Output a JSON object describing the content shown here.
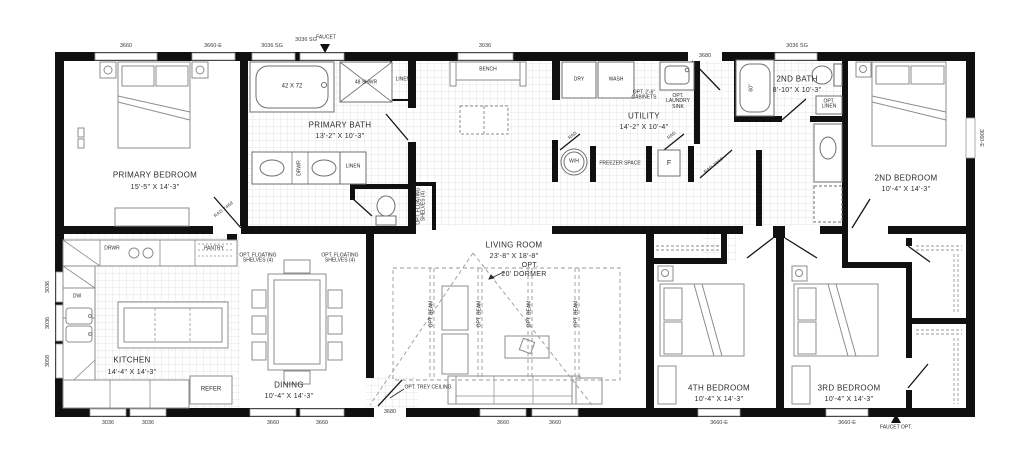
{
  "colors": {
    "wall": "#101010",
    "tile_line": "#dcdcdc",
    "furniture": "#8c8c8c",
    "text": "#2b2b2b"
  },
  "rooms": {
    "primary_bedroom": {
      "name": "PRIMARY BEDROOM",
      "dims": "15'-5\" X 14'-3\""
    },
    "primary_bath": {
      "name": "PRIMARY BATH",
      "dims": "13'-2\" X 10'-3\""
    },
    "utility": {
      "name": "UTILITY",
      "dims": "14'-2\" X 10'-4\""
    },
    "second_bath": {
      "name": "2ND BATH",
      "dims": "8'-10\" X 10'-3\""
    },
    "second_bedroom": {
      "name": "2ND BEDROOM",
      "dims": "10'-4\" X 14'-3\""
    },
    "kitchen": {
      "name": "KITCHEN",
      "dims": "14'-4\" X 14'-3\""
    },
    "dining": {
      "name": "DINING",
      "dims": "10'-4\" X 14'-3\""
    },
    "living_room": {
      "name": "LIVING ROOM",
      "dims": "23'-8\" X 18'-8\"",
      "opt": "OPT.",
      "dormer": "20' DORMER"
    },
    "fourth_bedroom": {
      "name": "4TH BEDROOM",
      "dims": "10'-4\" X 14'-3\""
    },
    "third_bedroom": {
      "name": "3RD BEDROOM",
      "dims": "10'-4\" X 14'-3\""
    }
  },
  "labels": {
    "tub": "42 X 72",
    "shower": "48 SHWR",
    "linen_upper": "LINEN",
    "linen_vanity": "LINEN",
    "drwr_vanity": "DRWR",
    "faucet_top": "FAUCET",
    "bench": "BENCH",
    "dry": "DRY",
    "wash": "WASH",
    "opt_cabinets": "OPT. 2'-6\" CABINETS",
    "opt_laundry_sink": "OPT. LAUNDRY SINK",
    "water_heater": "W/H",
    "freezer": "FREEZER SPACE",
    "f_box": "F",
    "rad_left": "RAD",
    "rad_right": "RAD",
    "door_primary": "RAD 2468",
    "door_hall": "RAD 2868",
    "tub60": "60\"",
    "opt_linen": "OPT. LINEN",
    "drwr_kitchen": "DRWR",
    "pantry": "PANTRY",
    "dw": "DW",
    "refer": "REFER",
    "shelves_a": "OPT. FLOATING SHELVES (4)",
    "shelves_b": "OPT. FLOATING SHELVES (4)",
    "shelves_c": "OPT. FLOATING SHELVES (4)",
    "trey": "OPT. TREY CEILING",
    "beam": "OPT. BEAM",
    "faucet_opt": "FAUCET OPT."
  },
  "sizes": {
    "top_3660": "3660",
    "top_3660e": "3660-E",
    "top_3036sg_1": "3036 SG",
    "top_3036sg_2": "3036 SG",
    "top_3036": "3036",
    "top_3680": "3680",
    "top_3036sg_3": "3036 SG",
    "right_3060e": "3060-E",
    "left_3036_1": "3036",
    "left_3036_2": "3036",
    "left_3058": "3058",
    "bot_3036_1": "3036",
    "bot_3036_2": "3036",
    "bot_3660_1": "3660",
    "bot_3660_2": "3660",
    "bot_3680": "3680",
    "bot_3660_3": "3660",
    "bot_3660_4": "3660",
    "bot_3660e_1": "3660-E",
    "bot_3660e_2": "3660-E"
  }
}
